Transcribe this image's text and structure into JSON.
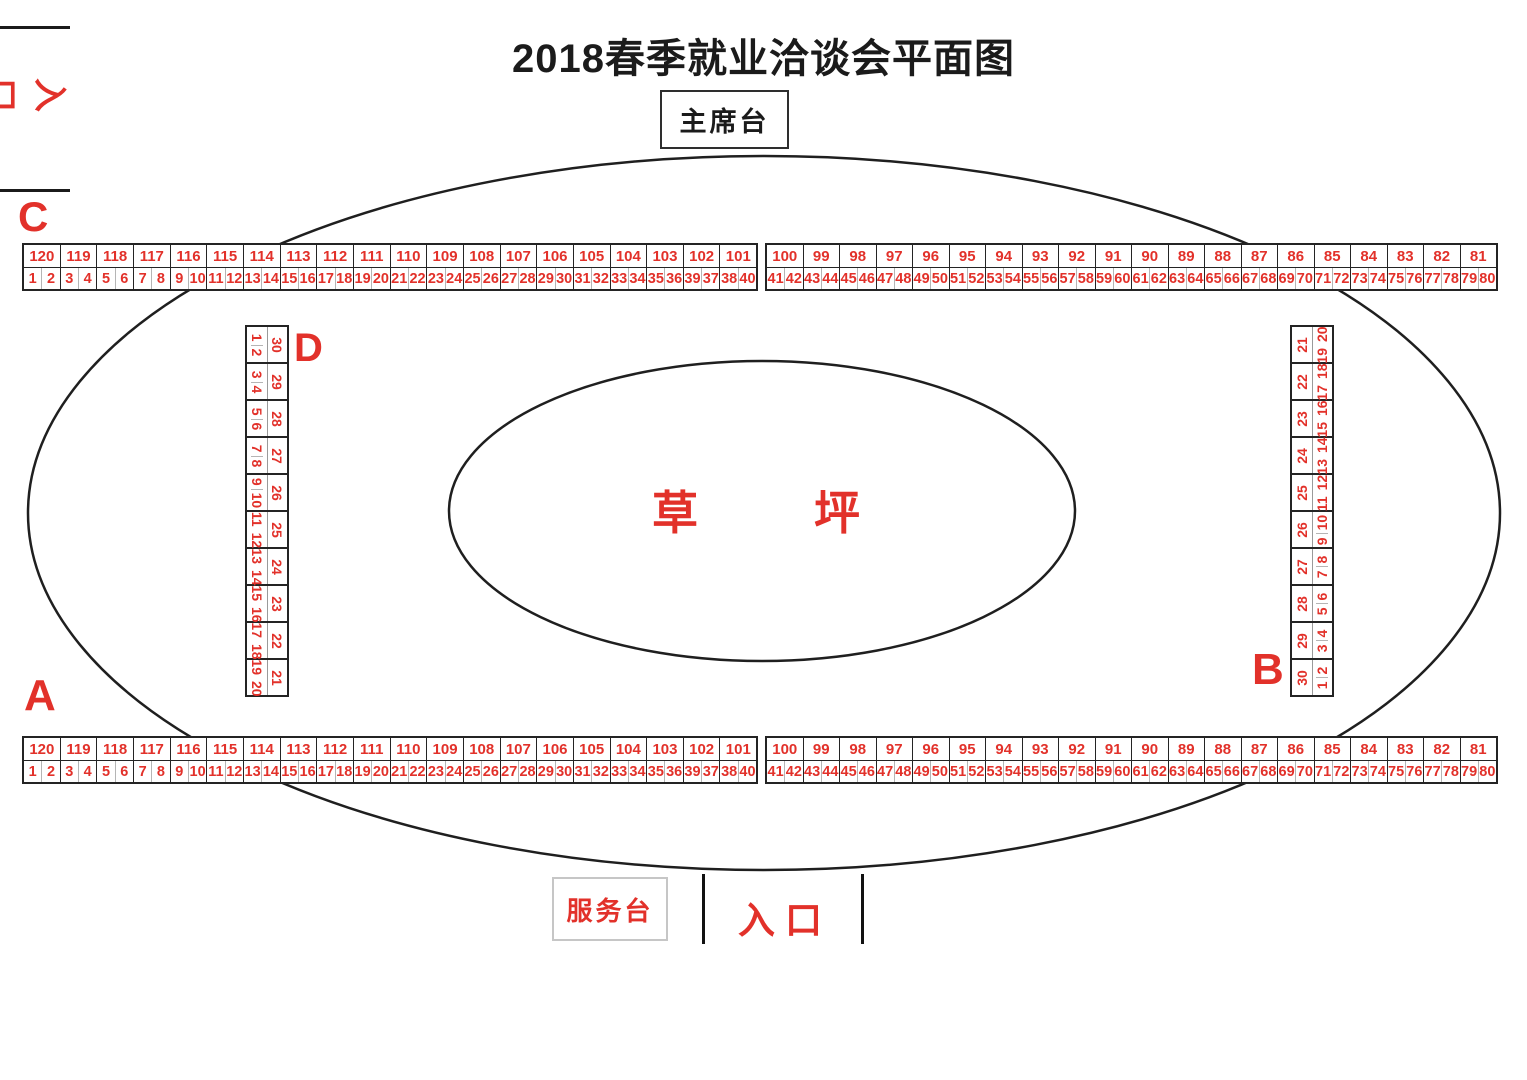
{
  "title": "2018春季就业洽谈会平面图",
  "colors": {
    "red": "#e2312a",
    "line_black": "#242424",
    "divider_gray": "#b5b5b5"
  },
  "labels": {
    "stage": "主席台",
    "service_desk": "服务台",
    "entrance_left": "入口",
    "entrance_bottom": "入口",
    "lawn_char_1": "草",
    "lawn_char_2": "坪",
    "zone_a": "A",
    "zone_b": "B",
    "zone_c": "C",
    "zone_d": "D"
  },
  "strips": {
    "left": {
      "booths": [
        "120",
        "119",
        "118",
        "117",
        "116",
        "115",
        "114",
        "113",
        "112",
        "111",
        "110",
        "109",
        "108",
        "107",
        "106",
        "105",
        "104",
        "103",
        "102",
        "101"
      ],
      "pairs": [
        [
          "1",
          "2"
        ],
        [
          "3",
          "4"
        ],
        [
          "5",
          "6"
        ],
        [
          "7",
          "8"
        ],
        [
          "9",
          "10"
        ],
        [
          "11",
          "12"
        ],
        [
          "13",
          "14"
        ],
        [
          "15",
          "16"
        ],
        [
          "17",
          "18"
        ],
        [
          "19",
          "20"
        ],
        [
          "21",
          "22"
        ],
        [
          "23",
          "24"
        ],
        [
          "25",
          "26"
        ],
        [
          "27",
          "28"
        ],
        [
          "29",
          "30"
        ],
        [
          "31",
          "32"
        ],
        [
          "33",
          "34"
        ],
        [
          "35",
          "36"
        ],
        [
          "39",
          "37"
        ],
        [
          "38",
          "40"
        ]
      ]
    },
    "right": {
      "booths": [
        "100",
        "99",
        "98",
        "97",
        "96",
        "95",
        "94",
        "93",
        "92",
        "91",
        "90",
        "89",
        "88",
        "87",
        "86",
        "85",
        "84",
        "83",
        "82",
        "81"
      ],
      "pairs": [
        [
          "41",
          "42"
        ],
        [
          "43",
          "44"
        ],
        [
          "45",
          "46"
        ],
        [
          "47",
          "48"
        ],
        [
          "49",
          "50"
        ],
        [
          "51",
          "52"
        ],
        [
          "53",
          "54"
        ],
        [
          "55",
          "56"
        ],
        [
          "57",
          "58"
        ],
        [
          "59",
          "60"
        ],
        [
          "61",
          "62"
        ],
        [
          "63",
          "64"
        ],
        [
          "65",
          "66"
        ],
        [
          "67",
          "68"
        ],
        [
          "69",
          "70"
        ],
        [
          "71",
          "72"
        ],
        [
          "73",
          "74"
        ],
        [
          "75",
          "76"
        ],
        [
          "77",
          "78"
        ],
        [
          "79",
          "80"
        ]
      ]
    },
    "d_column": {
      "booths": [
        "30",
        "29",
        "28",
        "27",
        "26",
        "25",
        "24",
        "23",
        "22",
        "21"
      ],
      "pairs": [
        [
          "1",
          "2"
        ],
        [
          "3",
          "4"
        ],
        [
          "5",
          "6"
        ],
        [
          "7",
          "8"
        ],
        [
          "9",
          "10"
        ],
        [
          "11",
          "12"
        ],
        [
          "13",
          "14"
        ],
        [
          "15",
          "16"
        ],
        [
          "17",
          "18"
        ],
        [
          "19",
          "20"
        ]
      ]
    },
    "b_column": {
      "booths": [
        "21",
        "22",
        "23",
        "24",
        "25",
        "26",
        "27",
        "28",
        "29",
        "30"
      ],
      "pairs": [
        [
          "19",
          "20"
        ],
        [
          "17",
          "18"
        ],
        [
          "15",
          "16"
        ],
        [
          "13",
          "14"
        ],
        [
          "11",
          "12"
        ],
        [
          "9",
          "10"
        ],
        [
          "7",
          "8"
        ],
        [
          "5",
          "6"
        ],
        [
          "3",
          "4"
        ],
        [
          "1",
          "2"
        ]
      ]
    }
  }
}
